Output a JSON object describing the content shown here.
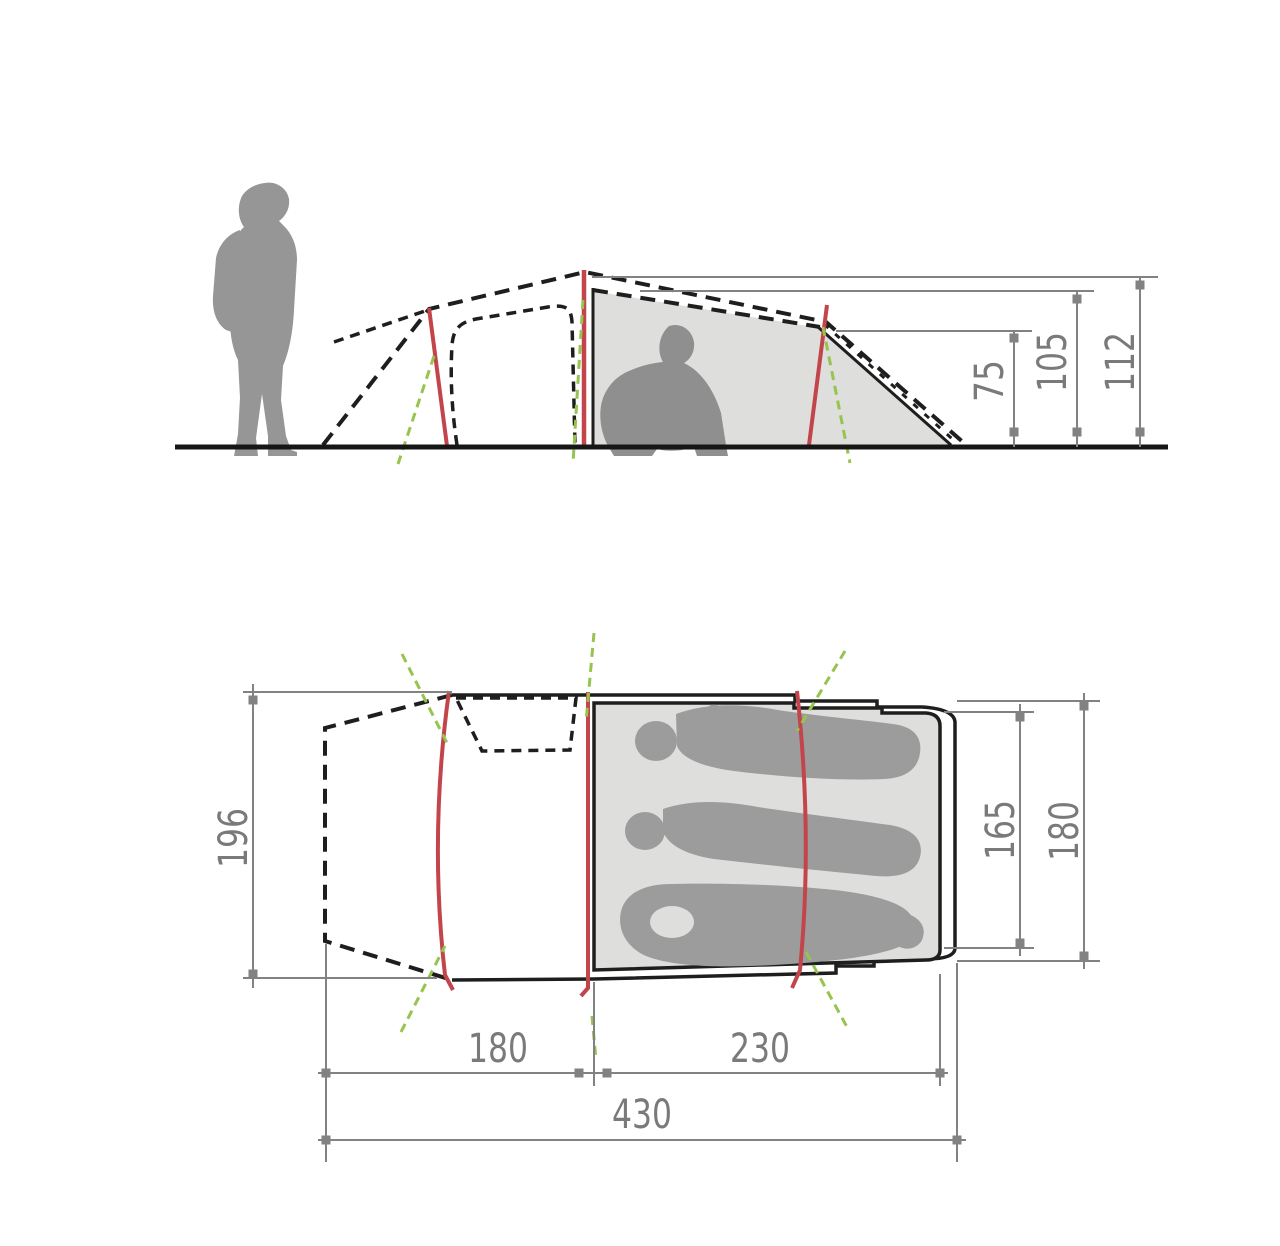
{
  "diagram": {
    "kind": "tent-dimension-drawing",
    "views": {
      "side": "side-elevation",
      "plan": "floor-plan"
    },
    "labels": {
      "side_rear_height": "75",
      "side_inner_height": "105",
      "side_peak_height": "112",
      "plan_outer_width": "196",
      "plan_inner_width": "165",
      "plan_rear_width": "180",
      "plan_front_length": "180",
      "plan_inner_length": "230",
      "plan_total_length": "430"
    },
    "colors": {
      "outline": "#1e1e1e",
      "dimension_lines": "#828282",
      "label_text": "#7a7a7a",
      "pole_red": "#c2454b",
      "guyline_green": "#97c34f",
      "inner_tent_fill": "#dededc",
      "figure_gray": "#969696",
      "sleeper_gray": "#9c9c9c"
    }
  }
}
